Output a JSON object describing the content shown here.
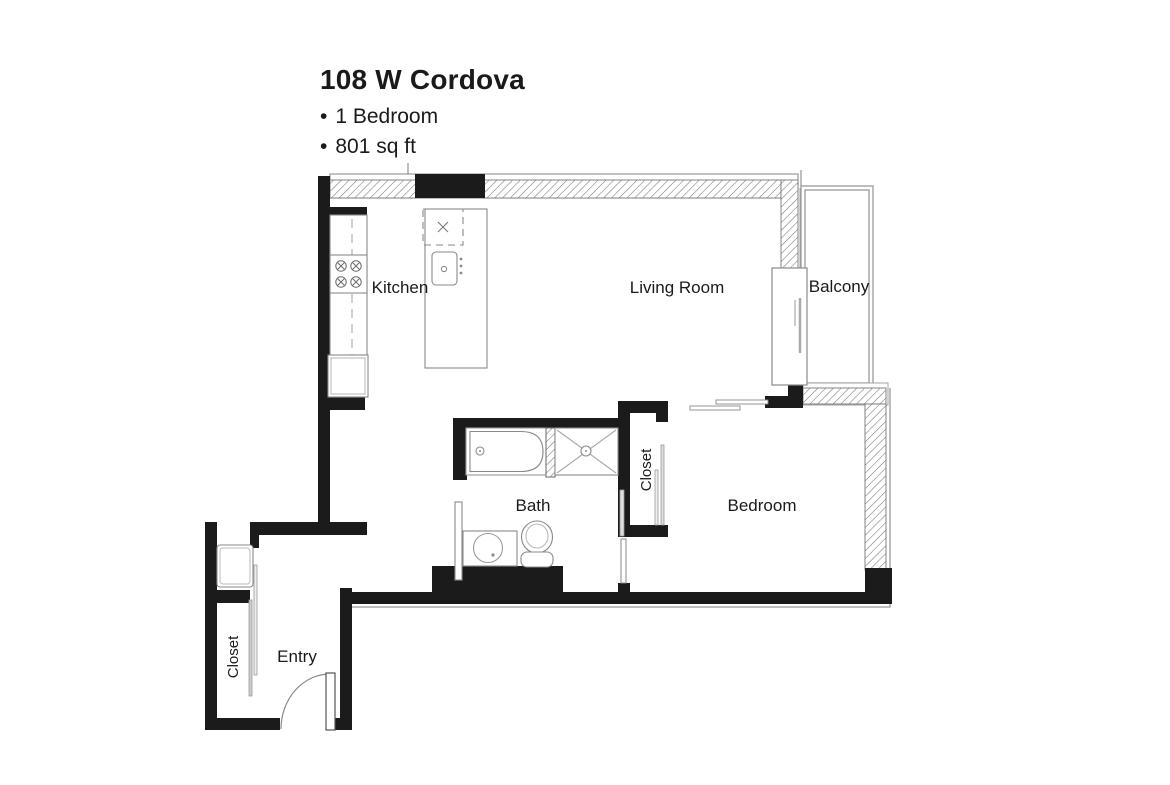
{
  "header": {
    "title": "108 W Cordova",
    "bullet": "•",
    "details": [
      {
        "label": "1 Bedroom"
      },
      {
        "label": "801 sq ft"
      }
    ]
  },
  "rooms": {
    "kitchen": {
      "label": "Kitchen"
    },
    "living_room": {
      "label": "Living Room"
    },
    "balcony": {
      "label": "Balcony"
    },
    "bath": {
      "label": "Bath"
    },
    "bedroom": {
      "label": "Bedroom"
    },
    "bedroom_closet": {
      "label": "Closet"
    },
    "entry_closet": {
      "label": "Closet"
    },
    "entry": {
      "label": "Entry"
    }
  },
  "fixtures": [
    "cooktop-burners",
    "refrigerator",
    "kitchen-island",
    "island-sink",
    "island-hood",
    "bathtub",
    "shower-stall",
    "toilet",
    "vanity-sink",
    "closet-rods",
    "sliding-balcony-door",
    "entry-swing-door",
    "washer-unit"
  ],
  "colors": {
    "wall": "#1b1b1b",
    "hatch_line": "#777777",
    "thin_line": "#8a8a8a",
    "text": "#1a1a1a",
    "background": "#ffffff"
  }
}
